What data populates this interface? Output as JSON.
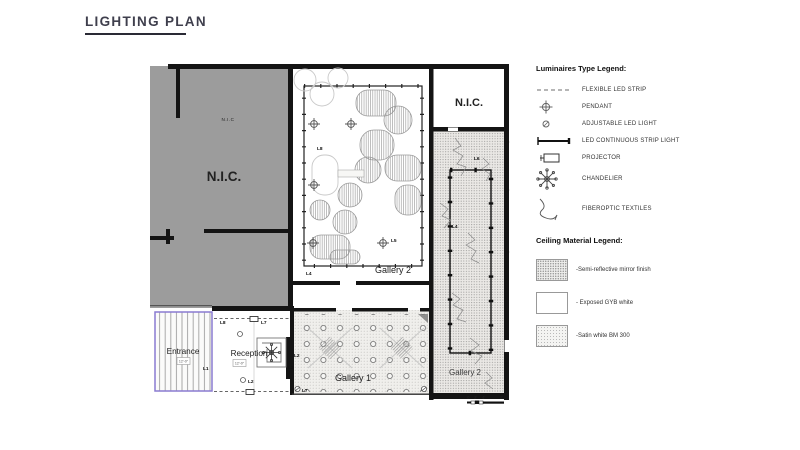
{
  "title": "LIGHTING PLAN",
  "plan": {
    "rooms": {
      "nic_small": "N.I.C",
      "nic_large": "N.I.C.",
      "nic_top": "N.I.C.",
      "gallery2_main": "Gallery 2",
      "gallery2_side": "Gallery 2",
      "gallery1": "Gallery 1",
      "entrance": "Entrance",
      "reception": "Reception"
    },
    "height_tags": {
      "entrance": "12'-0\"",
      "reception": "12'-0\""
    },
    "light_tags": {
      "l1": "L1",
      "l2": "L2",
      "l3": "L3",
      "l4": "L4",
      "l5": "L5",
      "l6": "L6",
      "l7": "L7",
      "l8": "L8"
    },
    "scale_bar": {
      "t0": "0",
      "t1": "2'",
      "t2": "4'",
      "t3": "8'"
    }
  },
  "luminaire_legend": {
    "title": "Luminaires Type Legend:",
    "items": [
      {
        "icon": "flexible-led-strip-icon",
        "label": "FLEXIBLE LED STRIP"
      },
      {
        "icon": "pendant-icon",
        "label": "PENDANT"
      },
      {
        "icon": "adjustable-led-icon",
        "label": "ADJUSTABLE LED LIGHT"
      },
      {
        "icon": "led-strip-light-icon",
        "label": "LED CONTINUOUS STRIP LIGHT"
      },
      {
        "icon": "projector-icon",
        "label": "PROJECTOR"
      },
      {
        "icon": "chandelier-icon",
        "label": "CHANDELIER"
      },
      {
        "icon": "fiberoptic-icon",
        "label": "FIBEROPTIC TEXTILES"
      }
    ]
  },
  "ceiling_legend": {
    "title": "Ceiling Material Legend:",
    "items": [
      {
        "swatch": "stipple-dense",
        "label": "-Semi-reflective mirror finish"
      },
      {
        "swatch": "white",
        "label": "- Exposed GYB white"
      },
      {
        "swatch": "stipple-light",
        "label": "-Satin white BM 300"
      }
    ]
  },
  "colors": {
    "wall": "#141414",
    "nic_fill": "#9c9c9c",
    "stipple_fill": "#eceae8",
    "entrance_outline": "#8a7bd1",
    "title_text": "#3f3f4d"
  }
}
